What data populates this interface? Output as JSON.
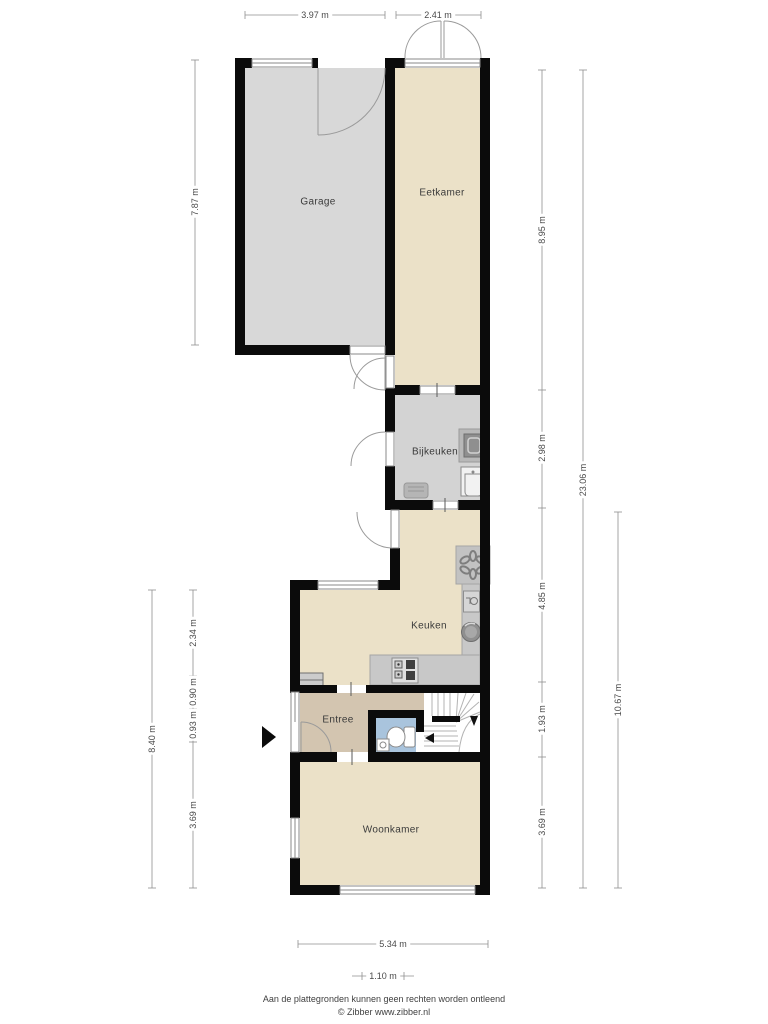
{
  "plan": {
    "type": "floorplan",
    "level_note": "ground floor",
    "rooms": {
      "garage": {
        "label": "Garage",
        "floor_color": "#d8d8d8"
      },
      "eetkamer": {
        "label": "Eetkamer",
        "floor_color": "#ebe1c8"
      },
      "bijkeuken": {
        "label": "Bijkeuken",
        "floor_color": "#d3d3d3"
      },
      "keuken": {
        "label": "Keuken",
        "floor_color": "#ebe1c8"
      },
      "entree": {
        "label": "Entree",
        "floor_color": "#d3c5b0"
      },
      "toilet": {
        "label": "",
        "floor_color": "#a9c4dd"
      },
      "woonkamer": {
        "label": "Woonkamer",
        "floor_color": "#ebe1c8"
      }
    }
  },
  "dimensions": {
    "top": [
      "3.97 m",
      "2.41 m"
    ],
    "left": [
      "7.87 m",
      "2.34 m",
      "0.90 m",
      "0.93 m",
      "3.69 m",
      "8.40 m"
    ],
    "right": [
      "8.95 m",
      "2.98 m",
      "4.85 m",
      "1.93 m",
      "3.69 m",
      "23.06 m",
      "10.67 m"
    ],
    "bottom": [
      "5.34 m",
      "1.10 m"
    ]
  },
  "icons": {
    "entrance_arrow": "solid right-pointing triangle marking entrance",
    "stove": "four-burner cooktop",
    "kitchen_sink": "round basin",
    "dishwasher": "counter appliance with basin glyph",
    "ventilation_flower": "six-petal rosette on counter",
    "washing_machine": "square with drum ring",
    "utility_sink": "square basin",
    "toilet": "bowl with cistern",
    "stairs": "treads with winders and direction arrows",
    "meter_cupboard": "small grey cabinet at entree"
  },
  "colors": {
    "wall": "#0b0b0b",
    "counter": "#c8c8c8",
    "stove_dark": "#3f3f3f",
    "dimension_line": "#8f8f8f",
    "door_arc": "#9a9a9a",
    "stair_line": "#b3b3b3",
    "label_text": "#3a3a3a"
  },
  "footer": {
    "line1": "Aan de plattegronden kunnen geen rechten worden ontleend",
    "line2": "© Zibber www.zibber.nl"
  }
}
